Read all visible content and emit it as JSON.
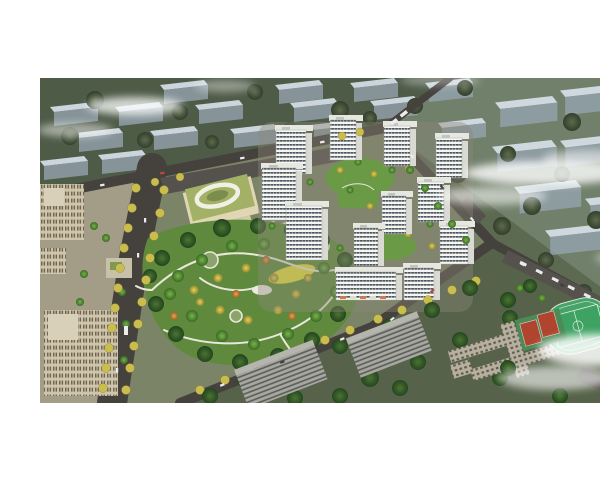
{
  "scene": {
    "title": "Aerial architectural rendering of a residential community master plan",
    "description": "Bird's-eye rendering: a cluster of about twelve white high-rise apartment towers with dark window bands arranged around landscaped green courtyards and a planted podium roof; a kindergarten with an olive-green roof and white oval courtyard ring; a large central park with winding white paths, a yellow playground and dense green, yellow and orange trees; tree-lined boulevards and roads with cars and buses; tan office buildings and a paved plaza on the west; grey existing residential slabs in the foreground; a school campus with a green running track, football pitch and two red basketball courts at the lower right; translucent blue-grey massing blocks of the surrounding city fade into the background under wispy white clouds.",
    "landmarks": [
      {
        "name": "residential-tower-cluster",
        "label": "White high-rise apartment towers around green courtyards",
        "count": 12
      },
      {
        "name": "central-park",
        "label": "Landscaped park with winding white paths and autumn trees"
      },
      {
        "name": "kindergarten",
        "label": "Kindergarten with green roof and oval courtyard ring"
      },
      {
        "name": "podium-garden",
        "label": "Planted podium roof garden between towers"
      },
      {
        "name": "sports-field",
        "label": "School running track and football pitch"
      },
      {
        "name": "basketball-courts",
        "label": "Two red basketball courts"
      },
      {
        "name": "office-buildings",
        "label": "Tan office buildings and plaza on the west edge"
      },
      {
        "name": "existing-buildings",
        "label": "Grey existing residential slabs in the foreground"
      },
      {
        "name": "context-massing",
        "label": "Translucent blue-grey city-context blocks in the background"
      },
      {
        "name": "tree-lined-boulevard",
        "label": "Boulevard lined with yellow autumn street trees"
      },
      {
        "name": "clouds",
        "label": "Wispy white clouds drifting over the scene"
      }
    ]
  },
  "palette": {
    "background_white": "#ffffff",
    "terrain_base": "#5d6a52",
    "terrain_northwest": "#4e5b47",
    "terrain_east": "#71806b",
    "terrain_south": "#56634a",
    "site_ground": "#7c8468",
    "plaza_paving": "#a39d88",
    "road_asphalt": "#45413d",
    "parking_asphalt": "#55514c",
    "park_green": "#5f8a3e",
    "path_white": "#e9e7da",
    "tree_yellow": "#c8bd4e",
    "tree_green": "#4f8034",
    "tree_dark": "#2e5a2b",
    "tree_olive": "#49573f",
    "tree_orange": "#cf9c42",
    "tower_white": "#f4f4f0",
    "tower_window_band": "#3a444e",
    "tower_side": "#d9dad3",
    "podium_green": "#6a9a45",
    "kindergarten_roof": "#a2b166",
    "kindergarten_wall": "#e0d6b4",
    "office_tan": "#cfc5ab",
    "office_window": "#6f6553",
    "existing_grey": "#a8a7a0",
    "existing_band": "#585d59",
    "context_face": "#95a3ae",
    "context_roof": "#d6e0e8",
    "field_green": "#3ea263",
    "court_red": "#b0452f",
    "playground_yellow": "#e4de3f",
    "cloud_white": "#ffffff"
  }
}
